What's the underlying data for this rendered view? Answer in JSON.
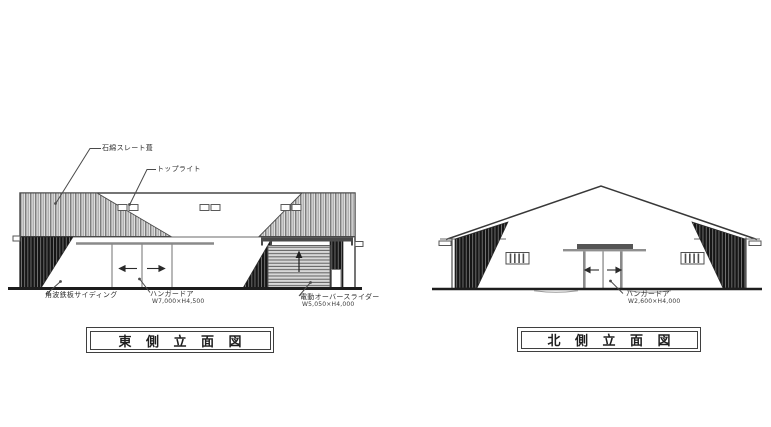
{
  "sheet": {
    "type": "architectural-elevation-drawing"
  },
  "drawings": {
    "east": {
      "title": "東 側 立 面 図",
      "labels": {
        "roof": "石綿スレート葺",
        "toplight": "トップライト",
        "siding": "角波鉄板サイディング",
        "hangar_door": "ハンガードア",
        "hangar_door_size": "W7,000×H4,500",
        "overhead_slider": "電動オーバースライダー",
        "overhead_slider_size": "W5,050×H4,000"
      }
    },
    "north": {
      "title": "北 側 立 面 図",
      "labels": {
        "hangar_door": "ハンガードア",
        "hangar_door_size": "W2,600×H4,000"
      }
    }
  },
  "colors": {
    "background": "#ffffff",
    "line": "#3a3a3a",
    "hatch_light_bg": "#e0e0e0",
    "hatch_light_line": "#6a6a6a",
    "hatch_dark_bg": "#161616",
    "hatch_dark_line": "#9a9a9a",
    "door_hatch_bg": "#d8d8d8",
    "ground": "#1d1d1d"
  }
}
